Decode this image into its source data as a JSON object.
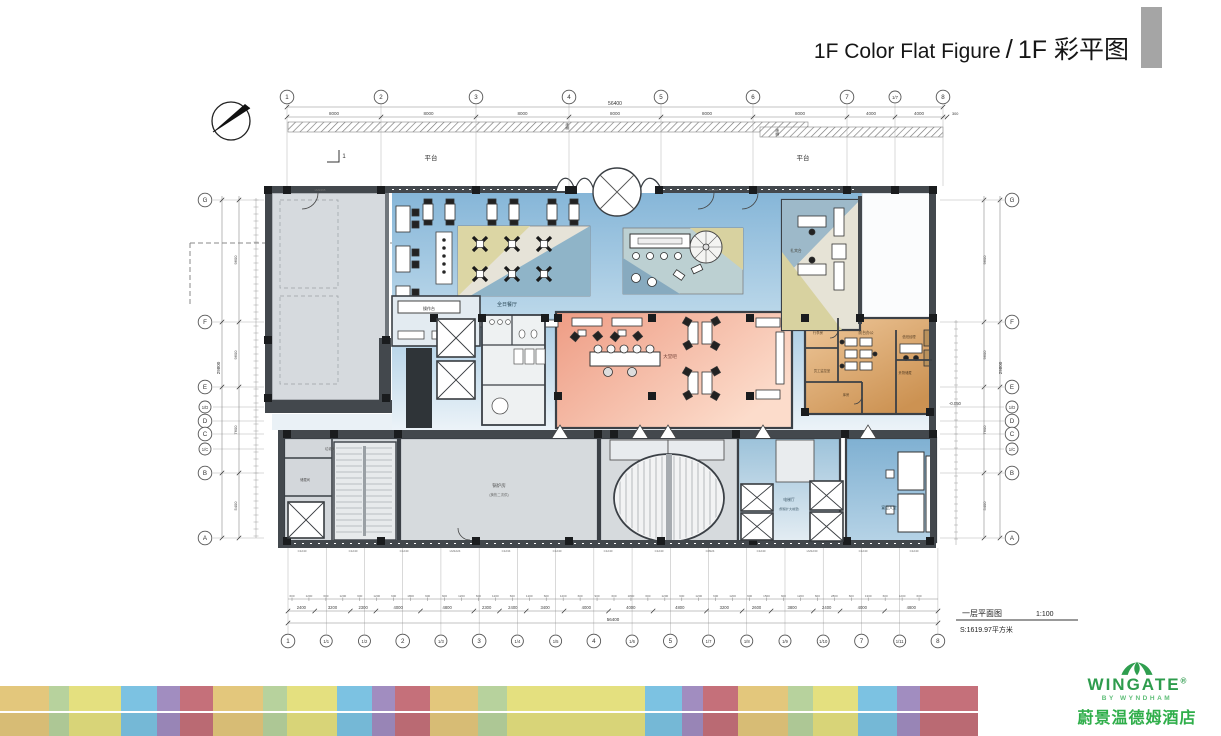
{
  "header": {
    "title_en": "1F Color Flat Figure",
    "title_sep": "/",
    "title_zh": "1F 彩平图"
  },
  "plan": {
    "caption": {
      "name": "一层平面图",
      "scale": "1:100",
      "area": "S:1619.97平方米"
    },
    "grid": {
      "top": [
        "1",
        "2",
        "3",
        "4",
        "5",
        "6",
        "7",
        "1/7",
        "8"
      ],
      "bottom": [
        "1",
        "1/1",
        "1/2",
        "2",
        "1/3",
        "3",
        "1/4",
        "1/5",
        "4",
        "1/6",
        "5",
        "1/7",
        "1/8",
        "1/9",
        "1/10",
        "7",
        "1/11",
        "8"
      ],
      "left": [
        "G",
        "F",
        "E",
        "1/D",
        "D",
        "C",
        "1/C",
        "B",
        "A"
      ],
      "right": [
        "G",
        "F",
        "E",
        "1/D",
        "D",
        "C",
        "1/C",
        "B",
        "A"
      ]
    },
    "dims": {
      "top_overall": "56400",
      "top_segments": [
        "8000",
        "8000",
        "8000",
        "8000",
        "8000",
        "8000",
        "4000",
        "4000"
      ],
      "top_end": "300",
      "bottom_overall": "56400",
      "bottom_segments": [
        "2400",
        "3200",
        "2300",
        "4000",
        "4800",
        "2300",
        "2400",
        "3400",
        "4000",
        "4000",
        "4800",
        "3200",
        "2600",
        "3800",
        "2400",
        "4000",
        "4800"
      ],
      "bottom_minor": [
        "600",
        "1200",
        "600",
        "1200",
        "600",
        "1200",
        "600",
        "1800",
        "600",
        "600",
        "1200",
        "600",
        "1200",
        "600",
        "1200",
        "600",
        "1200",
        "600",
        "900",
        "600",
        "1800",
        "600",
        "1200",
        "600",
        "1200",
        "600",
        "1200",
        "600",
        "1500",
        "600",
        "1200",
        "600",
        "2800",
        "600",
        "1300",
        "600",
        "1200",
        "600"
      ],
      "left": [
        "29800",
        "9600",
        "9600",
        "7600",
        "5400"
      ],
      "right": [
        "29800",
        "9600",
        "9600",
        "7600",
        "5400"
      ],
      "level": "-0.050"
    },
    "annotations": {
      "platform": "平台",
      "section": "1",
      "canopy": "雨棚",
      "door_code": "LM2465"
    },
    "window_codes": [
      "C1240",
      "C1240",
      "C1240",
      "LM1224",
      "C1234",
      "C1240",
      "C1240",
      "C1240",
      "C0924",
      "C1240",
      "LM1230",
      "C1240",
      "C1240"
    ],
    "rooms": {
      "all_day_dining": "全日餐厅",
      "operation_counter": "操作台",
      "lobby_bar": "大堂吧",
      "concierge": "礼宾台",
      "luggage": "行李房",
      "front_office": "前台办公",
      "duty_manager": "值班经理",
      "valuables": "贵物储藏",
      "monitor_room": "员工监控室",
      "store": "库房",
      "boiler": "锅炉房",
      "boiler_sub": "(换热二次供)",
      "trash": "垃圾房",
      "storage": "储藏间",
      "elevator_hall": "电梯厅",
      "elevator_hall_sub": "(预留扩大前室)",
      "banquet_lobby": "宴会大堂"
    }
  },
  "footer": {
    "strip": [
      [
        49,
        "#e3c77c"
      ],
      [
        20,
        "#b7d29d"
      ],
      [
        52,
        "#e4e07f"
      ],
      [
        36,
        "#7cc2e2"
      ],
      [
        23,
        "#a18dc0"
      ],
      [
        33,
        "#c5707a"
      ],
      [
        50,
        "#e3c77c"
      ],
      [
        24,
        "#b7d29d"
      ],
      [
        50,
        "#e4e07f"
      ],
      [
        35,
        "#7cc2e2"
      ],
      [
        23,
        "#a18dc0"
      ],
      [
        35,
        "#c5707a"
      ],
      [
        48,
        "#e3c77c"
      ],
      [
        29,
        "#b7d29d"
      ],
      [
        138,
        "#e4e07f"
      ],
      [
        37,
        "#7cc2e2"
      ],
      [
        21,
        "#a18dc0"
      ],
      [
        35,
        "#c5707a"
      ],
      [
        50,
        "#e3c77c"
      ],
      [
        25,
        "#b7d29d"
      ],
      [
        45,
        "#e4e07f"
      ],
      [
        39,
        "#7cc2e2"
      ],
      [
        23,
        "#a18dc0"
      ],
      [
        58,
        "#c5707a"
      ]
    ]
  },
  "logo": {
    "brand": "WINGATE",
    "reg": "®",
    "sub": "BY WYNDHAM",
    "cn": "蔚景温德姆酒店"
  }
}
